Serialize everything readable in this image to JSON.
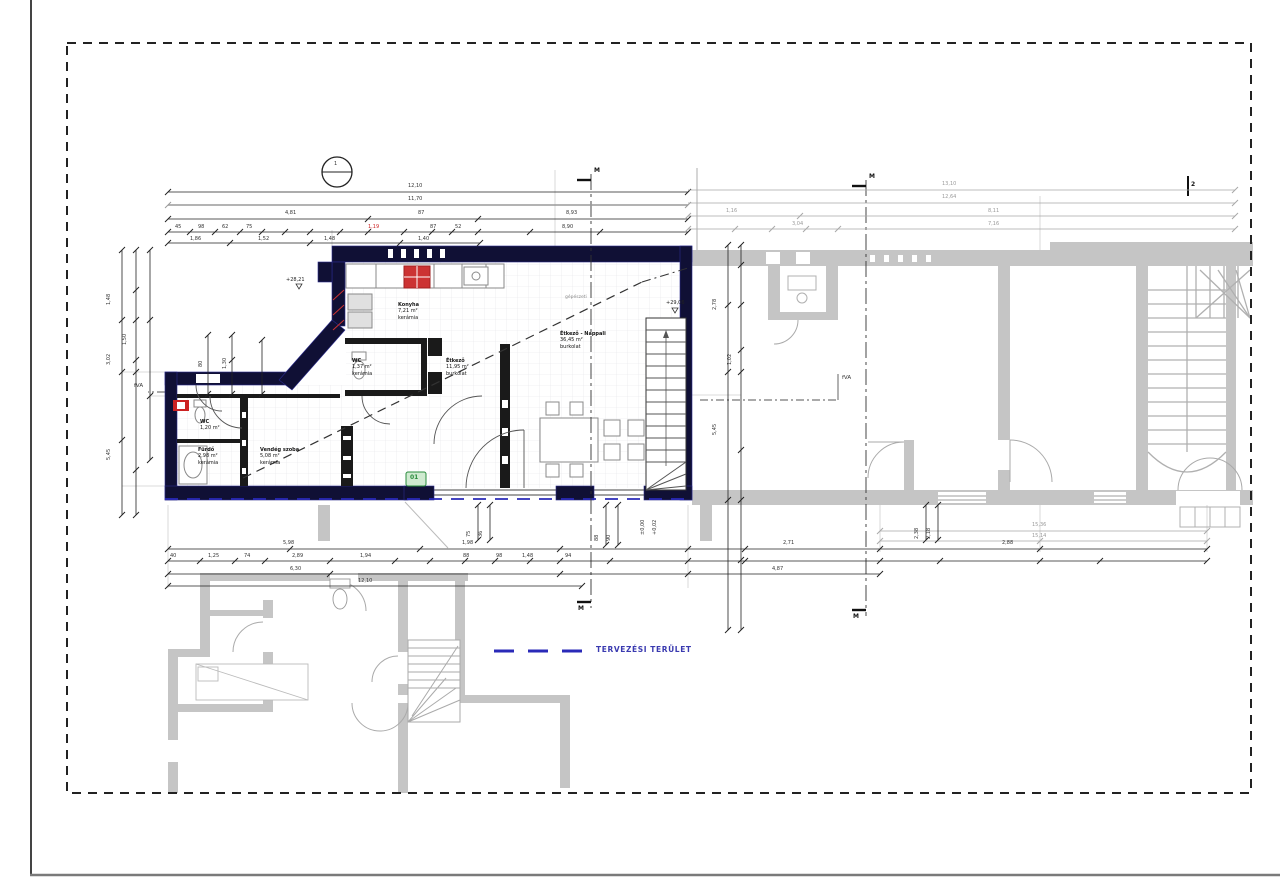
{
  "drawing": {
    "kind": "floor plan",
    "boundary_name": "design area boundary"
  },
  "legend": {
    "label": "TERVEZÉSI TERÜLET"
  },
  "rooms": [
    {
      "name": "Konyha",
      "area": "7,21 m²",
      "floor": "kerámia"
    },
    {
      "name": "WC",
      "area": "1,37 m²",
      "floor": "kerámia"
    },
    {
      "name": "Étkező",
      "area": "11,95 m²",
      "floor": "burkolat"
    },
    {
      "name": "Étkező - Nappali",
      "area": "36,45 m²",
      "floor": "burkolat"
    },
    {
      "name": "WC",
      "area": "1,20 m²",
      "floor": ""
    },
    {
      "name": "Fürdő",
      "area": "2,98 m²",
      "floor": "kerámia"
    },
    {
      "name": "Vendég szoba",
      "area": "5,08 m²",
      "floor": "kerámia"
    }
  ],
  "annotations": {
    "level_a": "+28,21",
    "level_b": "+29,06",
    "level_c": "±0,00",
    "level_d": "+0,02",
    "axis_label": "fVA",
    "section_label": "M",
    "axis_no": "2",
    "bubble": "1",
    "door_tag": "01",
    "note": "gépészeti"
  },
  "dims": {
    "top": [
      "12,10",
      "11,70",
      "4,81",
      "87",
      "8,93",
      "45",
      "98",
      "62",
      "75",
      "1,19",
      "87",
      "52",
      "8,90",
      "1,86",
      "1,52",
      "1,48",
      "1,40"
    ],
    "top_right": [
      "13,10",
      "12,64",
      "8,11",
      "7,16",
      "1,16",
      "3,04"
    ],
    "left": [
      "1,48",
      "3,02",
      "5,45",
      "1,50",
      "80",
      "1,30"
    ],
    "right": [
      "2,78",
      "5,45",
      "1,02"
    ],
    "bottom": [
      "5,98",
      "1,98",
      "2,71",
      "2,88",
      "40",
      "1,25",
      "74",
      "2,89",
      "1,94",
      "88",
      "98",
      "1,48",
      "6,30",
      "12,10",
      "4,87",
      "94"
    ],
    "bottom_right": [
      "15,36",
      "15,14"
    ],
    "mid": [
      "75",
      "36",
      "88",
      "90",
      "2,38",
      "2,18"
    ]
  },
  "colors": {
    "new_wall": "#101035",
    "existing_wall": "#c5c5c5",
    "boundary": "#222222",
    "design_area_blue": "#2a2ab8",
    "stove_red": "#cc3333",
    "tag_green": "#2a8c3c"
  }
}
